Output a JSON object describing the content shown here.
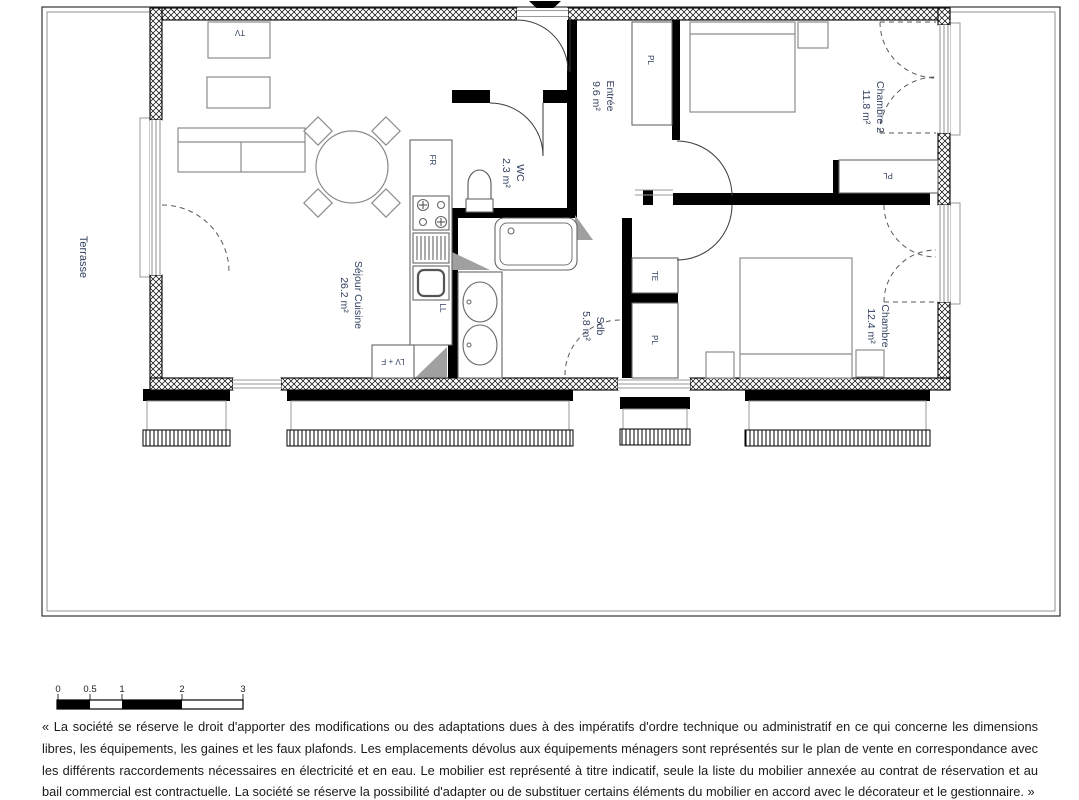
{
  "colors": {
    "wall": "#000000",
    "label": "#334060",
    "furniture_stroke": "#8c8c8c",
    "shaft_gray": "#a0a0a0"
  },
  "plan": {
    "terrace_label": "Terrasse",
    "rooms": [
      {
        "name": "Séjour Cuisine",
        "area": "26.2 m²"
      },
      {
        "name": "WC",
        "area": "2.3 m²"
      },
      {
        "name": "Entrée",
        "area": "9.6 m²"
      },
      {
        "name": "Chambre 2",
        "area": "11.8 m²"
      },
      {
        "name": "Sdb",
        "area": "5.8 m²"
      },
      {
        "name": "Chambre",
        "area": "12.4 m²"
      }
    ],
    "fixtures": {
      "tv": "TV",
      "fridge": "FR",
      "washer": "LL",
      "dishwasher_oven": "LV + F",
      "closet": "PL",
      "technical": "TE"
    }
  },
  "scale_bar": {
    "labels": [
      "0",
      "0.5",
      "1",
      "2",
      "3"
    ]
  },
  "disclaimer": "« La société se réserve le droit d'apporter des modifications ou des adaptations dues à des impératifs d'ordre technique ou administratif en ce qui concerne les dimensions libres, les équipements, les gaines et les faux plafonds. Les emplacements dévolus aux équipements ménagers sont représentés sur le plan de vente en correspondance avec les différents raccordements nécessaires en électricité et en eau. Le mobilier est représenté à titre indicatif, seule la liste du mobilier annexée au contrat de réservation et au bail commercial est contractuelle. La société se réserve la possibilité d'adapter ou de substituer certains éléments du mobilier en accord avec le décorateur et le gestionnaire. »"
}
